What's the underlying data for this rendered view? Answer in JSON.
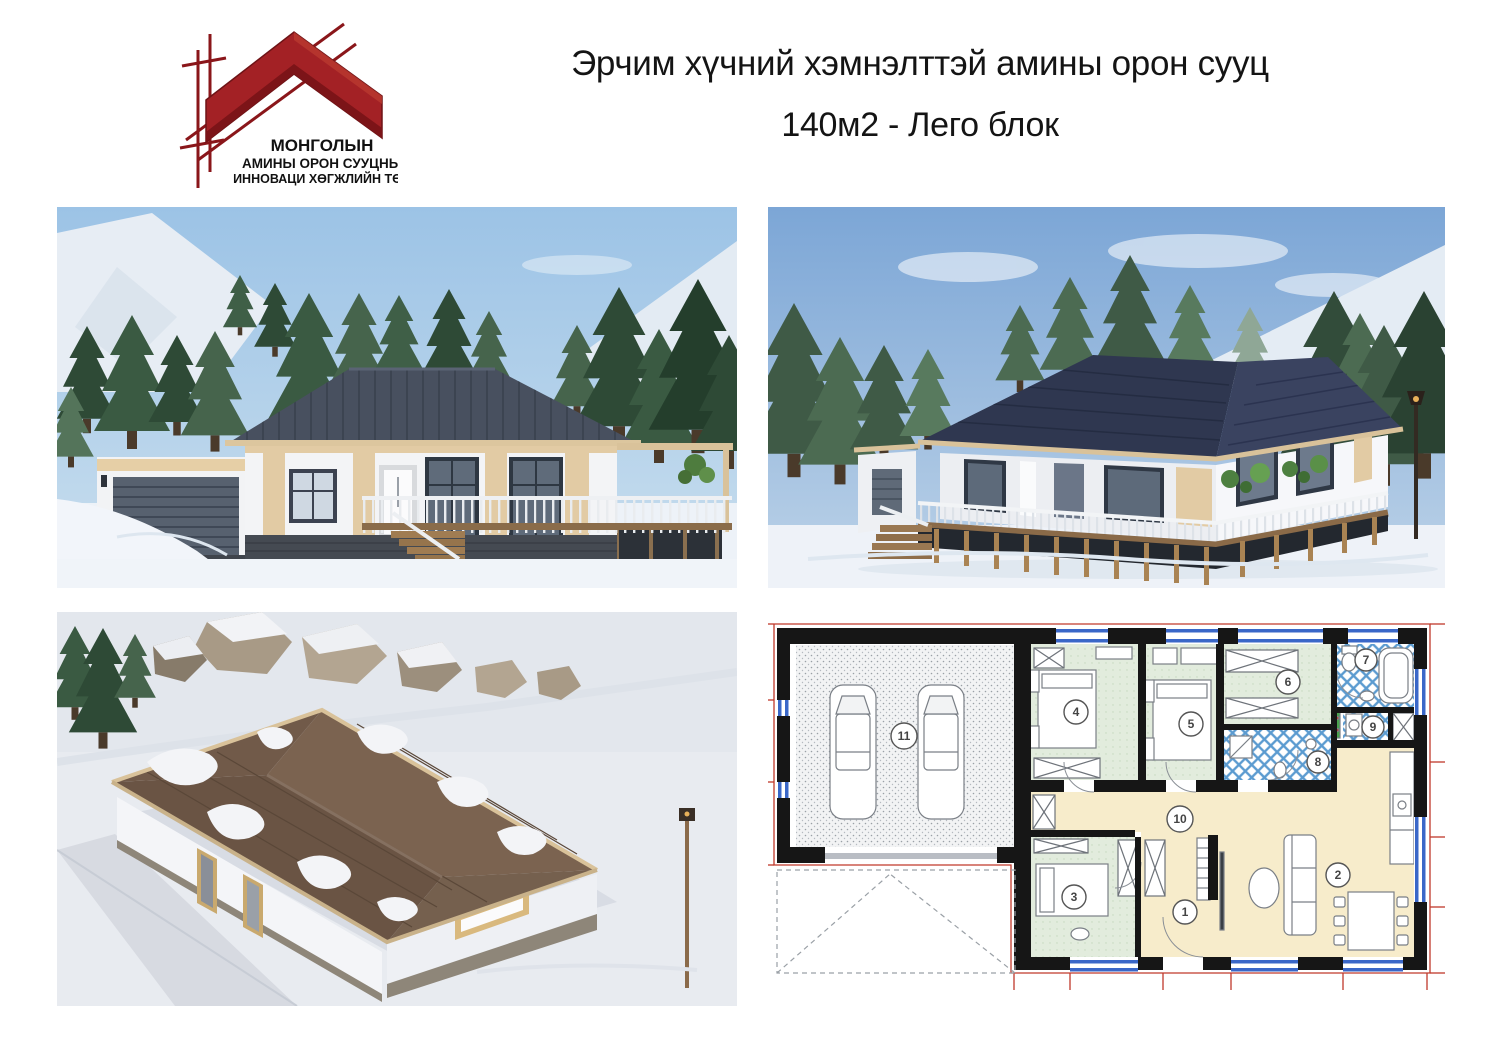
{
  "header": {
    "title_line1": "Эрчим хүчний хэмнэлттэй амины орон сууц",
    "title_line2": "140м2 - Лего блок"
  },
  "logo": {
    "org_line1": "МОНГОЛЫН",
    "org_line2": "АМИНЫ ОРОН СУУЦНЫ",
    "org_line3": "ИННОВАЦИ ХӨГЖЛИЙН ТӨВ",
    "colors": {
      "roof_red": "#a32125",
      "edge_dark_red": "#6e1316",
      "scaffold_red": "#8a161a",
      "text": "#111111"
    }
  },
  "panels": {
    "front_render_name": "front-elevation-render",
    "perspective_render_name": "perspective-render",
    "aerial_render_name": "aerial-render",
    "floor_plan_name": "floor-plan"
  },
  "floor_plan": {
    "room_numbers": [
      "1",
      "2",
      "3",
      "4",
      "5",
      "6",
      "7",
      "8",
      "9",
      "10",
      "11"
    ],
    "colors": {
      "wall": "#161616",
      "bedroom_floor": "#e2ecdd",
      "living_floor": "#f7eccb",
      "bath_tile_blue": "#5b9bd0",
      "window_blue": "#3a67c8",
      "dimension_red": "#c0392b"
    }
  }
}
